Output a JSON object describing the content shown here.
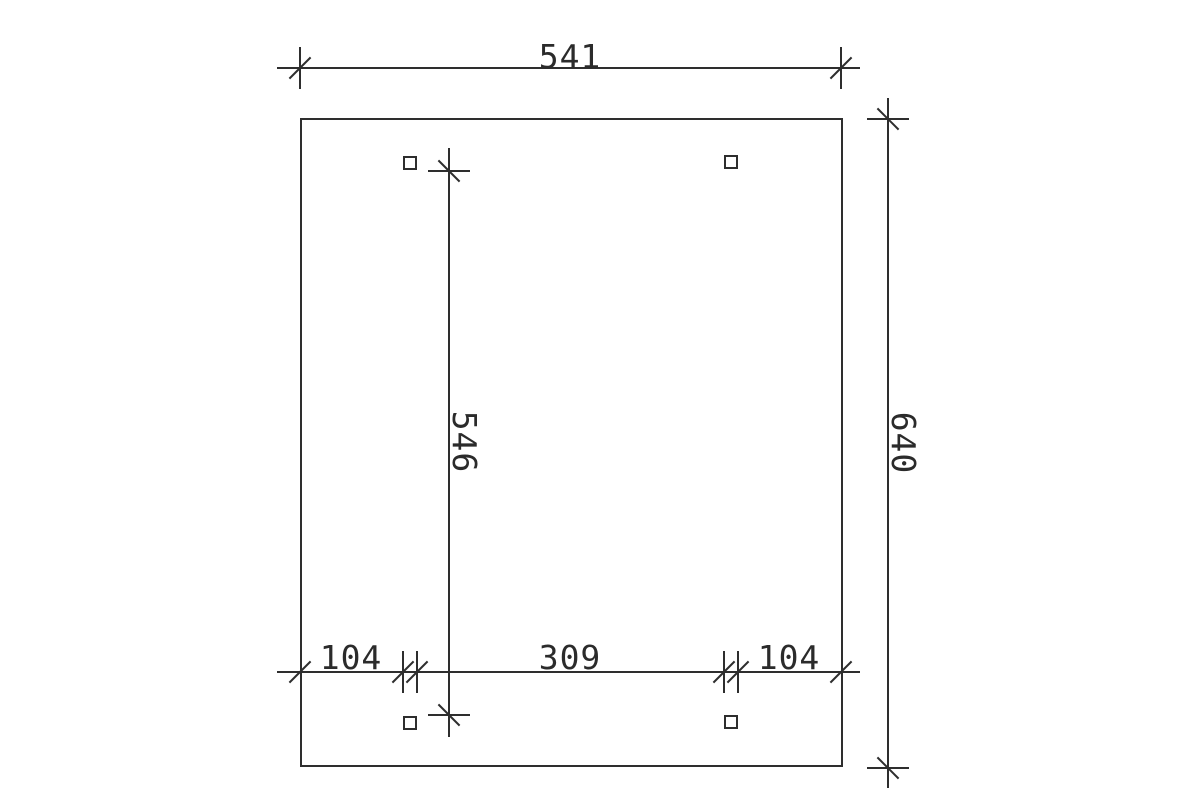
{
  "drawing": {
    "type": "technical-dimension-plan",
    "outline_shape": "rectangle",
    "posts": {
      "count": 4,
      "shape": "square"
    },
    "dim_top": {
      "label": "541",
      "orientation": "horizontal"
    },
    "dim_right": {
      "label": "640",
      "orientation": "vertical"
    },
    "dim_inner": {
      "label": "546",
      "orientation": "vertical"
    },
    "dim_bottom": {
      "orientation": "horizontal",
      "segments": [
        {
          "label": "104"
        },
        {
          "label": "309"
        },
        {
          "label": "104"
        }
      ]
    },
    "colors": {
      "line": "#2e2e2e",
      "background": "#ffffff"
    }
  }
}
